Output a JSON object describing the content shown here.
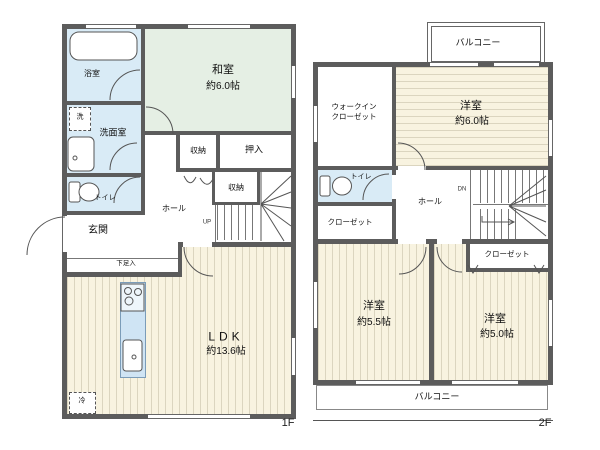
{
  "title": "floor-plan",
  "colors": {
    "wall": "#5c5c5c",
    "tatami_room": "#e5efe4",
    "wood_floor": "#f8f3e0",
    "wood_stripe": "#dbd5bf",
    "water_area": "#d9ebf6",
    "kitchen_counter": "#cfe4f4"
  },
  "f1": {
    "floor_label": "1F",
    "bath": "浴室",
    "washitsu_name": "和室",
    "washitsu_size": "約6.0帖",
    "laundry": "洗",
    "washroom": "洗面室",
    "toilet": "トイレ",
    "genkan": "玄関",
    "shoe": "下足入",
    "hall": "ホール",
    "up": "UP",
    "storage_a": "収納",
    "storage_b": "収納",
    "oshiire": "押入",
    "ldk_name": "LDK",
    "ldk_size": "約13.6帖",
    "fridge": "冷"
  },
  "f2": {
    "floor_label": "2F",
    "balcony_top": "バルコニー",
    "balcony_bottom": "バルコニー",
    "wic_line1": "ウォークイン",
    "wic_line2": "クローゼット",
    "room6_name": "洋室",
    "room6_size": "約6.0帖",
    "toilet": "トイレ",
    "hall": "ホール",
    "dn": "DN",
    "closet_left": "クローゼット",
    "closet_right": "クローゼット",
    "room55_name": "洋室",
    "room55_size": "約5.5帖",
    "room50_name": "洋室",
    "room50_size": "約5.0帖"
  }
}
